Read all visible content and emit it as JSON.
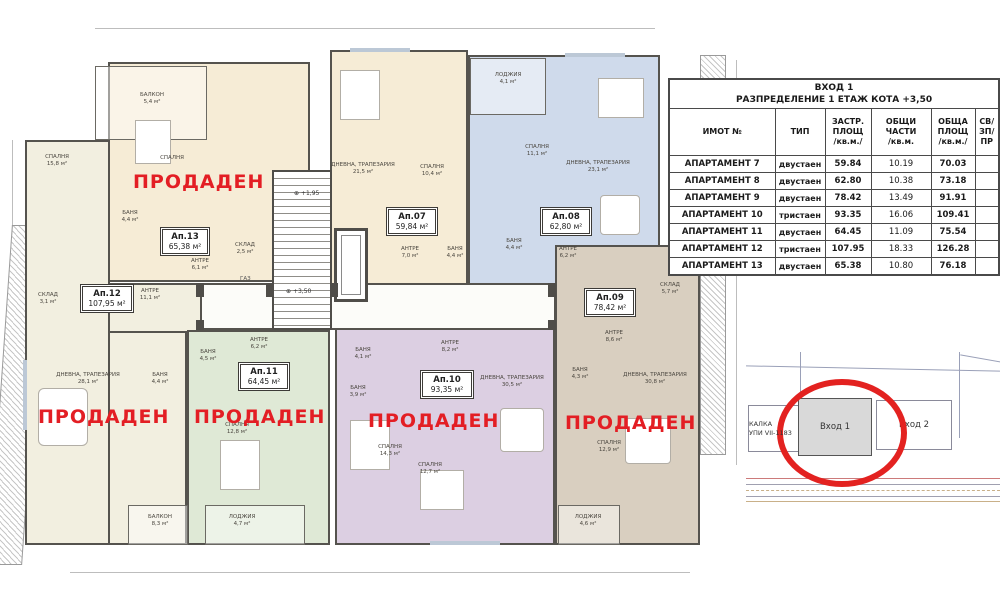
{
  "table": {
    "title_line1": "ВХОД 1",
    "title_line2": "РАЗПРЕДЕЛЕНИЕ 1 ЕТАЖ КОТА +3,50",
    "columns": [
      "ИМОТ №",
      "ТИП",
      "ЗАСТР.\nПЛОЩ\n/кв.м./",
      "ОБЩИ\nЧАСТИ\n/кв.м.",
      "ОБЩА\nПЛОЩ\n/кв.м./",
      "СВ/\nЗП/\nПР"
    ],
    "rows": [
      [
        "АПАРТАМЕНТ 7",
        "двустаен",
        "59.84",
        "10.19",
        "70.03",
        ""
      ],
      [
        "АПАРТАМЕНТ 8",
        "двустаен",
        "62.80",
        "10.38",
        "73.18",
        ""
      ],
      [
        "АПАРТАМЕНТ 9",
        "двустаен",
        "78.42",
        "13.49",
        "91.91",
        ""
      ],
      [
        "АПАРТАМЕНТ 10",
        "тристаен",
        "93.35",
        "16.06",
        "109.41",
        ""
      ],
      [
        "АПАРТАМЕНТ 11",
        "двустаен",
        "64.45",
        "11.09",
        "75.54",
        ""
      ],
      [
        "АПАРТАМЕНТ 12",
        "тристаен",
        "107.95",
        "18.33",
        "126.28",
        ""
      ],
      [
        "АПАРТАМЕНТ 13",
        "двустаен",
        "65.38",
        "10.80",
        "76.18",
        ""
      ]
    ]
  },
  "floor_plan": {
    "sold_stamp": "ПРОДАДЕН",
    "gas_label": "ГАЗ",
    "entrance2_side_label": "ВХОД 2",
    "stairs": {
      "level_mid": "+1,95",
      "level_main": "+3,50"
    },
    "apartments": [
      {
        "id": "Ап.13",
        "area": "65,38 м²",
        "color": "#f6ecd6",
        "rooms": [
          {
            "name": "БАЛКОН",
            "area": "5,4 м²"
          },
          {
            "name": "СПАЛНЯ",
            "area": ""
          },
          {
            "name": "БАНЯ",
            "area": "4,4 м²"
          },
          {
            "name": "АНТРЕ",
            "area": "6,1 м²"
          },
          {
            "name": "СКЛАД",
            "area": "2,5 м²"
          }
        ]
      },
      {
        "id": "Ап.07",
        "area": "59,84 м²",
        "color": "#f6ecd6",
        "rooms": [
          {
            "name": "ДНЕВНА, ТРАПЕЗАРИЯ",
            "area": "21,5 м²"
          },
          {
            "name": "СПАЛНЯ",
            "area": "10,4 м²"
          },
          {
            "name": "АНТРЕ",
            "area": "7,0 м²"
          },
          {
            "name": "БАНЯ",
            "area": "4,4 м²"
          }
        ]
      },
      {
        "id": "Ап.08",
        "area": "62,80 м²",
        "color": "#cfdaeb",
        "rooms": [
          {
            "name": "ЛОДЖИЯ",
            "area": "4,1 м²"
          },
          {
            "name": "СПАЛНЯ",
            "area": "11,1 м²"
          },
          {
            "name": "ДНЕВНА, ТРАПЕЗАРИЯ",
            "area": "23,1 м²"
          },
          {
            "name": "БАНЯ",
            "area": "4,4 м²"
          },
          {
            "name": "АНТРЕ",
            "area": "6,2 м²"
          }
        ]
      },
      {
        "id": "Ап.12",
        "area": "107,95 м²",
        "color": "#f2efe0",
        "rooms": [
          {
            "name": "СПАЛНЯ",
            "area": "15,8 м²"
          },
          {
            "name": "СКЛАД",
            "area": "3,1 м²"
          },
          {
            "name": "АНТРЕ",
            "area": "11,1 м²"
          },
          {
            "name": "ДНЕВНА, ТРАПЕЗАРИЯ",
            "area": "28,1 м²"
          },
          {
            "name": "БАНЯ",
            "area": "4,4 м²"
          },
          {
            "name": "БАЛКОН",
            "area": "8,3 м²"
          }
        ]
      },
      {
        "id": "Ап.11",
        "area": "64,45 м²",
        "color": "#dfe9d6",
        "rooms": [
          {
            "name": "БАНЯ",
            "area": "4,5 м²"
          },
          {
            "name": "АНТРЕ",
            "area": "6,2 м²"
          },
          {
            "name": "СПАЛНЯ",
            "area": "12,8 м²"
          },
          {
            "name": "ЛОДЖИЯ",
            "area": "4,7 м²"
          }
        ]
      },
      {
        "id": "Ап.10",
        "area": "93,35 м²",
        "color": "#dccfe2",
        "rooms": [
          {
            "name": "БАНЯ",
            "area": "4,1 м²"
          },
          {
            "name": "АНТРЕ",
            "area": "8,2 м²"
          },
          {
            "name": "БАНЯ",
            "area": "3,9 м²"
          },
          {
            "name": "ДНЕВНА, ТРАПЕЗАРИЯ",
            "area": "30,5 м²"
          },
          {
            "name": "СПАЛНЯ",
            "area": "14,3 м²"
          },
          {
            "name": "СПАЛНЯ",
            "area": "12,7 м²"
          }
        ]
      },
      {
        "id": "Ап.09",
        "area": "78,42 м²",
        "color": "#d9cfc0",
        "rooms": [
          {
            "name": "СКЛАД",
            "area": "5,7 м²"
          },
          {
            "name": "АНТРЕ",
            "area": "8,6 м²"
          },
          {
            "name": "БАНЯ",
            "area": "4,3 м²"
          },
          {
            "name": "ДНЕВНА, ТРАПЕЗАРИЯ",
            "area": "30,8 м²"
          },
          {
            "name": "СПАЛНЯ",
            "area": "12,9 м²"
          },
          {
            "name": "ЛОДЖИЯ",
            "area": "4,6 м²"
          }
        ]
      }
    ]
  },
  "site_plan": {
    "building_1": "Вход 1",
    "building_2": "Вход 2",
    "left_label_line1": "КАЛКА",
    "left_label_line2": "УПИ VII-1183"
  },
  "colors": {
    "sold_red": "#e31e24",
    "circle_red": "#e32220"
  }
}
